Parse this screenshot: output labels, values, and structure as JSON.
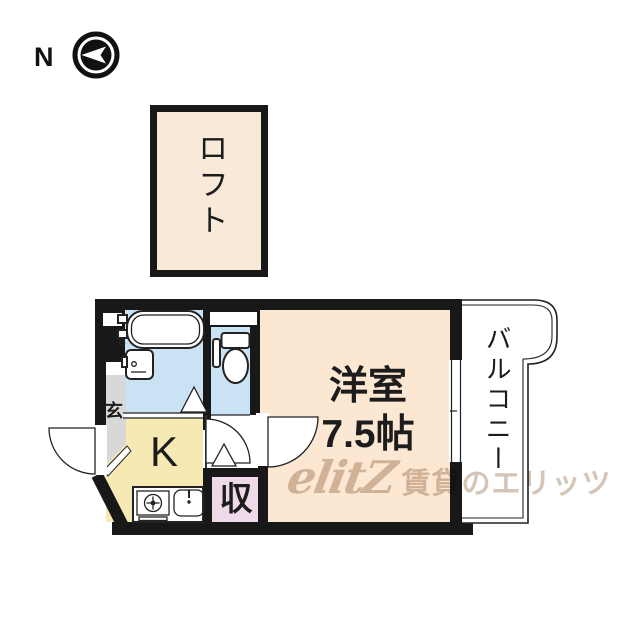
{
  "compass": {
    "north_label": "N"
  },
  "loft": {
    "label": "ロフト"
  },
  "plan": {
    "western_room": {
      "name": "洋室",
      "size": "7.5帖"
    },
    "kitchen": {
      "label": "K"
    },
    "storage": {
      "label": "収"
    },
    "entrance": {
      "label": "玄"
    },
    "balcony": {
      "label": "バルコニー"
    }
  },
  "watermark": {
    "logo": "elitZ",
    "text": "賃貸のエリッツ"
  },
  "colors": {
    "wall": "#181818",
    "room-cream": "#FBE7D2",
    "loft-cream": "#F8E9D8",
    "kitchen-yellow": "#F6E9B4",
    "storage-pink": "#EDD9E8",
    "bath-blue": "#C9E2F4",
    "genkan-gray": "#D8D8D8",
    "watermark": "#C9B6A5"
  }
}
